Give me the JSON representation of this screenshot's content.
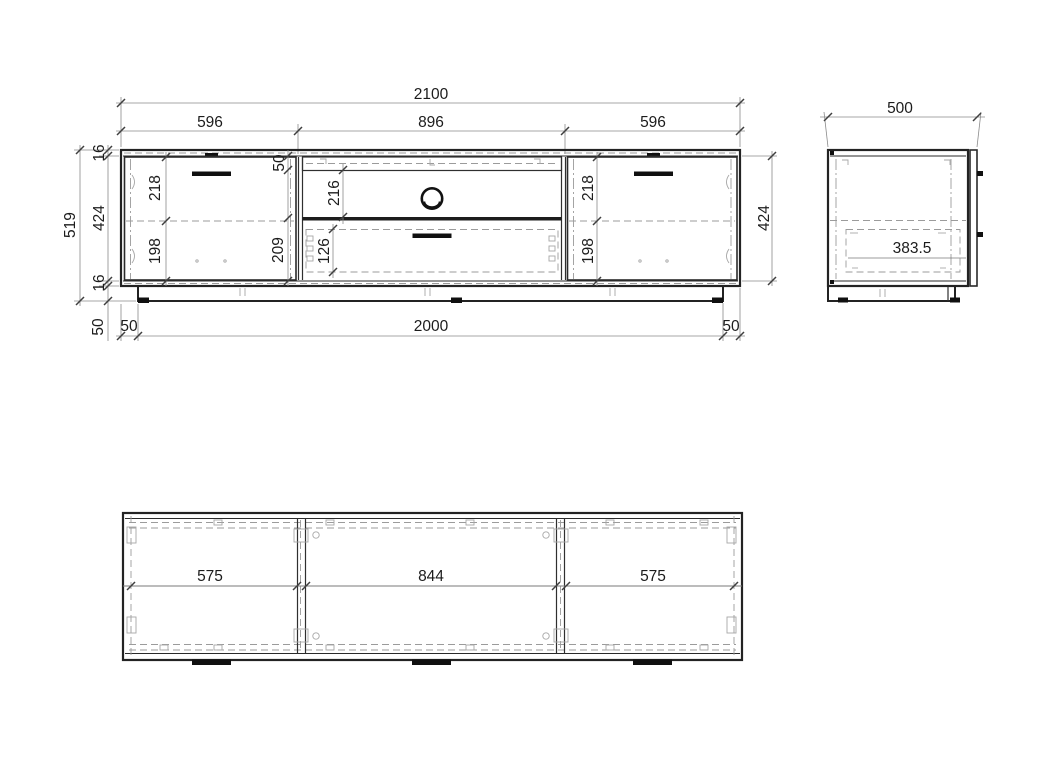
{
  "drawing": {
    "front_view": {
      "width_total": "2100",
      "width_left_door": "596",
      "width_center": "896",
      "width_right_door": "596",
      "height_total": "519",
      "top_panel_thickness": "16",
      "interior_height_left": "424",
      "bottom_panel_thickness": "16",
      "plinth_height": "50",
      "plinth_inset_left": "50",
      "plinth_width": "2000",
      "plinth_inset_right": "50",
      "left_door_upper": "218",
      "left_door_lower": "198",
      "center_top_rail": "50",
      "center_shelf_opening": "216",
      "center_lower_section": "209",
      "drawer_front_height": "126",
      "right_door_upper": "218",
      "right_door_lower": "198",
      "interior_height_right": "424"
    },
    "side_view": {
      "depth_total": "500",
      "interior_depth": "383.5"
    },
    "top_view": {
      "bay_left": "575",
      "bay_center": "844",
      "bay_right": "575"
    }
  }
}
